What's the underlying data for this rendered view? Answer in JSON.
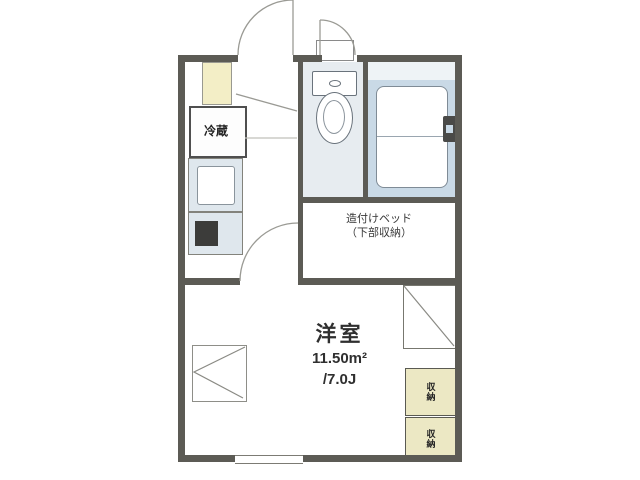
{
  "floorplan": {
    "type": "apartment-floor-plan",
    "room": {
      "name": "洋室",
      "area_m2": "11.50m²",
      "area_tatami": "/7.0J"
    },
    "bed_note": {
      "line1": "造付けベッド",
      "line2": "（下部収納）"
    },
    "kitchen": {
      "fridge_label": "冷蔵"
    },
    "storage": {
      "box1_label": "収納",
      "box2_label": "収納"
    },
    "colors": {
      "wall": "#5c5b55",
      "bathroom_fill": "#c9d9e6",
      "toilet_room_fill": "#e7ecf0",
      "kitchen_unit_fill": "#dfe7ed",
      "cabinet_cream": "#f3eec6",
      "storage_cream": "#ece8c4",
      "text": "#333333"
    }
  }
}
